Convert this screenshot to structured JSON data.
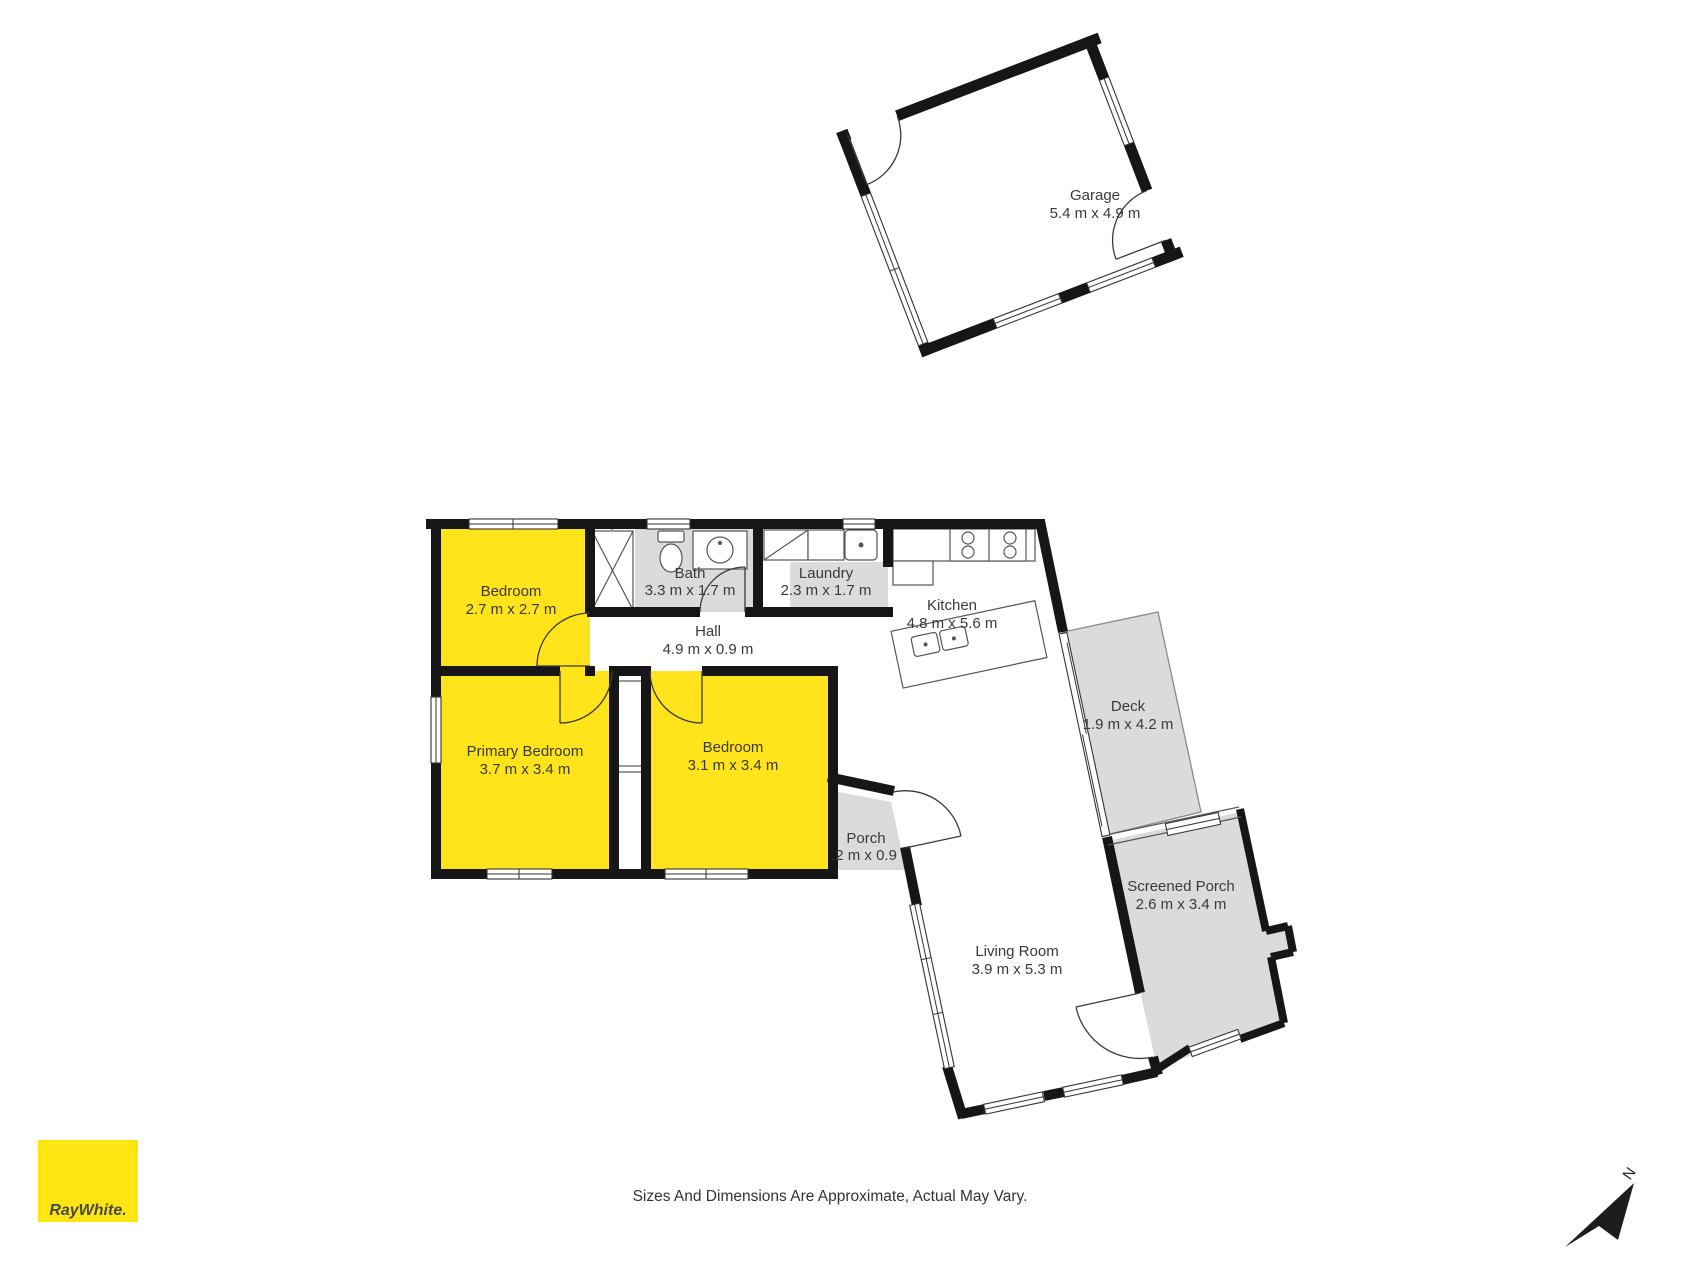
{
  "meta": {
    "colors": {
      "background": "#ffffff",
      "walls": "#161616",
      "highlight_room_yellow": "#FFE41C",
      "outdoor_area_gray": "#DBDBDB",
      "brand_yellow": "#FFE512",
      "label_text": "#3A3A3A"
    }
  },
  "rooms": {
    "garage": {
      "name": "Garage",
      "dims": "5.4 m x 4.9 m"
    },
    "bedroom_top": {
      "name": "Bedroom",
      "dims": "2.7 m x 2.7 m"
    },
    "bath": {
      "name": "Bath",
      "dims": "3.3 m x 1.7 m"
    },
    "laundry": {
      "name": "Laundry",
      "dims": "2.3 m x 1.7 m"
    },
    "kitchen": {
      "name": "Kitchen",
      "dims": "4.8 m x 5.6 m"
    },
    "hall": {
      "name": "Hall",
      "dims": "4.9 m x 0.9 m"
    },
    "primary_bedroom": {
      "name": "Primary Bedroom",
      "dims": "3.7 m x 3.4 m"
    },
    "bedroom_mid": {
      "name": "Bedroom",
      "dims": "3.1 m x 3.4 m"
    },
    "porch": {
      "name": "Porch",
      "dims": ".2 m x 0.9"
    },
    "living_room": {
      "name": "Living Room",
      "dims": "3.9 m x 5.3 m"
    },
    "deck": {
      "name": "Deck",
      "dims": "1.9 m x 4.2 m"
    },
    "screened_porch": {
      "name": "Screened Porch",
      "dims": "2.6 m x 3.4 m"
    }
  },
  "branding": {
    "logo_text": "RayWhite."
  },
  "footer": {
    "disclaimer": "Sizes And Dimensions Are Approximate, Actual May Vary."
  },
  "compass": {
    "label": "N"
  }
}
